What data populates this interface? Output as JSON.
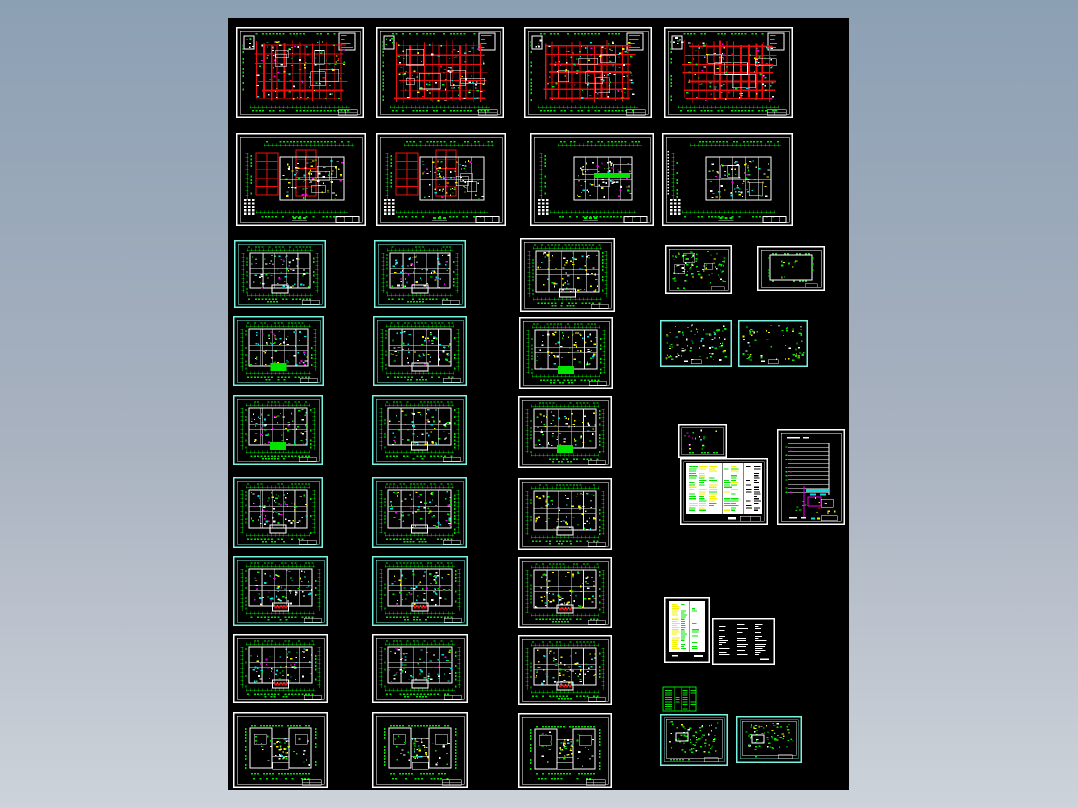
{
  "canvas": {
    "background_top": "#8ca0b4",
    "background_bottom": "#cdd3da",
    "board": {
      "x": 228,
      "y": 18,
      "w": 621,
      "h": 772,
      "color": "#000000"
    }
  },
  "palette": {
    "red": "#ea0e0e",
    "green": "#00e400",
    "cyan": "#00e0e0",
    "yellow": "#f2f200",
    "magenta": "#ee00ee",
    "white": "#ffffff",
    "black": "#000000",
    "frame_cyan": "#79f2e2",
    "frame_white": "#ffffff",
    "frame_green": "#00e400"
  },
  "sheets": [
    {
      "id": "plan-1",
      "style": "plan-red",
      "frame": "white",
      "x": 236,
      "y": 27,
      "w": 128,
      "h": 91,
      "seed": 11
    },
    {
      "id": "plan-2",
      "style": "plan-red",
      "frame": "white",
      "x": 376,
      "y": 27,
      "w": 128,
      "h": 91,
      "seed": 22
    },
    {
      "id": "plan-3",
      "style": "plan-red",
      "frame": "white",
      "x": 524,
      "y": 27,
      "w": 128,
      "h": 91,
      "seed": 33
    },
    {
      "id": "plan-4",
      "style": "plan-red",
      "frame": "white",
      "x": 664,
      "y": 27,
      "w": 129,
      "h": 91,
      "seed": 44
    },
    {
      "id": "plan-5",
      "style": "plan-blocks",
      "frame": "white",
      "x": 236,
      "y": 133,
      "w": 130,
      "h": 93,
      "seed": 55,
      "redBlocks": true
    },
    {
      "id": "plan-6",
      "style": "plan-blocks",
      "frame": "white",
      "x": 376,
      "y": 133,
      "w": 130,
      "h": 93,
      "seed": 66,
      "redBlocks": true
    },
    {
      "id": "plan-7",
      "style": "plan-blocks",
      "frame": "white",
      "x": 530,
      "y": 133,
      "w": 124,
      "h": 93,
      "seed": 77,
      "greenBar": true
    },
    {
      "id": "plan-8",
      "style": "plan-blocks",
      "frame": "white",
      "x": 662,
      "y": 133,
      "w": 131,
      "h": 93,
      "seed": 88,
      "leftDots": true
    },
    {
      "id": "tower-1",
      "style": "tower",
      "frame": "cyan",
      "x": 234,
      "y": 240,
      "w": 92,
      "h": 68,
      "seed": 101,
      "accent": "white"
    },
    {
      "id": "tower-2",
      "style": "tower",
      "frame": "cyan",
      "x": 374,
      "y": 240,
      "w": 92,
      "h": 68,
      "seed": 102,
      "accent": "white"
    },
    {
      "id": "tower-3",
      "style": "tower",
      "frame": "white",
      "x": 520,
      "y": 238,
      "w": 95,
      "h": 74,
      "seed": 103,
      "accent": "white",
      "warm": true
    },
    {
      "id": "small-plan-1",
      "style": "small-dense",
      "frame": "white",
      "x": 665,
      "y": 245,
      "w": 67,
      "h": 49,
      "seed": 104
    },
    {
      "id": "small-plan-2",
      "style": "small-outline",
      "frame": "white",
      "x": 757,
      "y": 246,
      "w": 68,
      "h": 45,
      "seed": 105
    },
    {
      "id": "tower-4",
      "style": "tower",
      "frame": "cyan",
      "x": 233,
      "y": 316,
      "w": 91,
      "h": 70,
      "seed": 106,
      "accent": "green"
    },
    {
      "id": "tower-5",
      "style": "tower",
      "frame": "cyan",
      "x": 373,
      "y": 316,
      "w": 94,
      "h": 70,
      "seed": 107,
      "accent": "white"
    },
    {
      "id": "tower-6",
      "style": "tower",
      "frame": "white",
      "x": 519,
      "y": 317,
      "w": 94,
      "h": 72,
      "seed": 108,
      "accent": "green",
      "warm": true
    },
    {
      "id": "small-plan-3",
      "style": "small-cyan",
      "frame": "cyan",
      "x": 660,
      "y": 320,
      "w": 72,
      "h": 47,
      "seed": 109,
      "dense": true
    },
    {
      "id": "small-plan-4",
      "style": "small-cyan",
      "frame": "cyan",
      "x": 738,
      "y": 320,
      "w": 70,
      "h": 47,
      "seed": 110,
      "dense": false
    },
    {
      "id": "tower-7",
      "style": "tower",
      "frame": "cyan",
      "x": 233,
      "y": 395,
      "w": 90,
      "h": 70,
      "seed": 111,
      "accent": "green"
    },
    {
      "id": "tower-8",
      "style": "tower",
      "frame": "cyan",
      "x": 372,
      "y": 395,
      "w": 95,
      "h": 70,
      "seed": 112,
      "accent": "white"
    },
    {
      "id": "tower-9",
      "style": "tower",
      "frame": "white",
      "x": 518,
      "y": 396,
      "w": 94,
      "h": 72,
      "seed": 113,
      "accent": "green",
      "warm": true
    },
    {
      "id": "detail-plan",
      "style": "tiny-plan",
      "frame": "white",
      "x": 678,
      "y": 424,
      "w": 49,
      "h": 34,
      "seed": 114
    },
    {
      "id": "schedule",
      "style": "schedule",
      "frame": "white",
      "x": 680,
      "y": 458,
      "w": 88,
      "h": 67,
      "seed": 115
    },
    {
      "id": "riser-diagram",
      "style": "riser",
      "frame": "white",
      "x": 777,
      "y": 429,
      "w": 68,
      "h": 96,
      "seed": 116
    },
    {
      "id": "tower-10",
      "style": "tower",
      "frame": "cyan",
      "x": 233,
      "y": 477,
      "w": 90,
      "h": 71,
      "seed": 117,
      "accent": "white"
    },
    {
      "id": "tower-11",
      "style": "tower",
      "frame": "cyan",
      "x": 372,
      "y": 477,
      "w": 95,
      "h": 71,
      "seed": 118,
      "accent": "white"
    },
    {
      "id": "tower-12",
      "style": "tower",
      "frame": "white",
      "x": 518,
      "y": 478,
      "w": 94,
      "h": 72,
      "seed": 119,
      "accent": "white",
      "warm": true
    },
    {
      "id": "tower-13",
      "style": "tower",
      "frame": "cyan",
      "x": 233,
      "y": 556,
      "w": 95,
      "h": 70,
      "seed": 120,
      "accent": "red"
    },
    {
      "id": "tower-14",
      "style": "tower",
      "frame": "cyan",
      "x": 372,
      "y": 556,
      "w": 96,
      "h": 70,
      "seed": 121,
      "accent": "red"
    },
    {
      "id": "tower-15",
      "style": "tower",
      "frame": "white",
      "x": 518,
      "y": 557,
      "w": 94,
      "h": 71,
      "seed": 122,
      "accent": "red",
      "warm": true
    },
    {
      "id": "legend-sheet",
      "style": "legend",
      "frame": "white",
      "x": 664,
      "y": 597,
      "w": 46,
      "h": 66,
      "seed": 123
    },
    {
      "id": "notes-sheet",
      "style": "notes",
      "frame": "white",
      "x": 712,
      "y": 618,
      "w": 63,
      "h": 47,
      "seed": 124
    },
    {
      "id": "tower-16",
      "style": "tower",
      "frame": "white",
      "x": 233,
      "y": 634,
      "w": 95,
      "h": 69,
      "seed": 125,
      "accent": "red"
    },
    {
      "id": "tower-17",
      "style": "tower",
      "frame": "white",
      "x": 372,
      "y": 634,
      "w": 96,
      "h": 69,
      "seed": 126,
      "accent": "white"
    },
    {
      "id": "tower-18",
      "style": "tower",
      "frame": "white",
      "x": 518,
      "y": 635,
      "w": 94,
      "h": 70,
      "seed": 127,
      "accent": "red",
      "warm": true
    },
    {
      "id": "roof-1",
      "style": "roof",
      "frame": "white",
      "x": 233,
      "y": 712,
      "w": 95,
      "h": 76,
      "seed": 128
    },
    {
      "id": "roof-2",
      "style": "roof",
      "frame": "white",
      "x": 372,
      "y": 712,
      "w": 96,
      "h": 76,
      "seed": 129
    },
    {
      "id": "roof-3",
      "style": "roof",
      "frame": "white",
      "x": 518,
      "y": 713,
      "w": 94,
      "h": 75,
      "seed": 130
    },
    {
      "id": "mini-table",
      "style": "green-table",
      "frame": "green",
      "x": 662,
      "y": 686,
      "w": 35,
      "h": 26,
      "seed": 131
    },
    {
      "id": "small-plan-5",
      "style": "small-cyan2",
      "frame": "cyan",
      "x": 660,
      "y": 714,
      "w": 68,
      "h": 52,
      "seed": 132
    },
    {
      "id": "small-plan-6",
      "style": "small-cyan2",
      "frame": "cyan",
      "x": 736,
      "y": 716,
      "w": 66,
      "h": 47,
      "seed": 133
    }
  ]
}
